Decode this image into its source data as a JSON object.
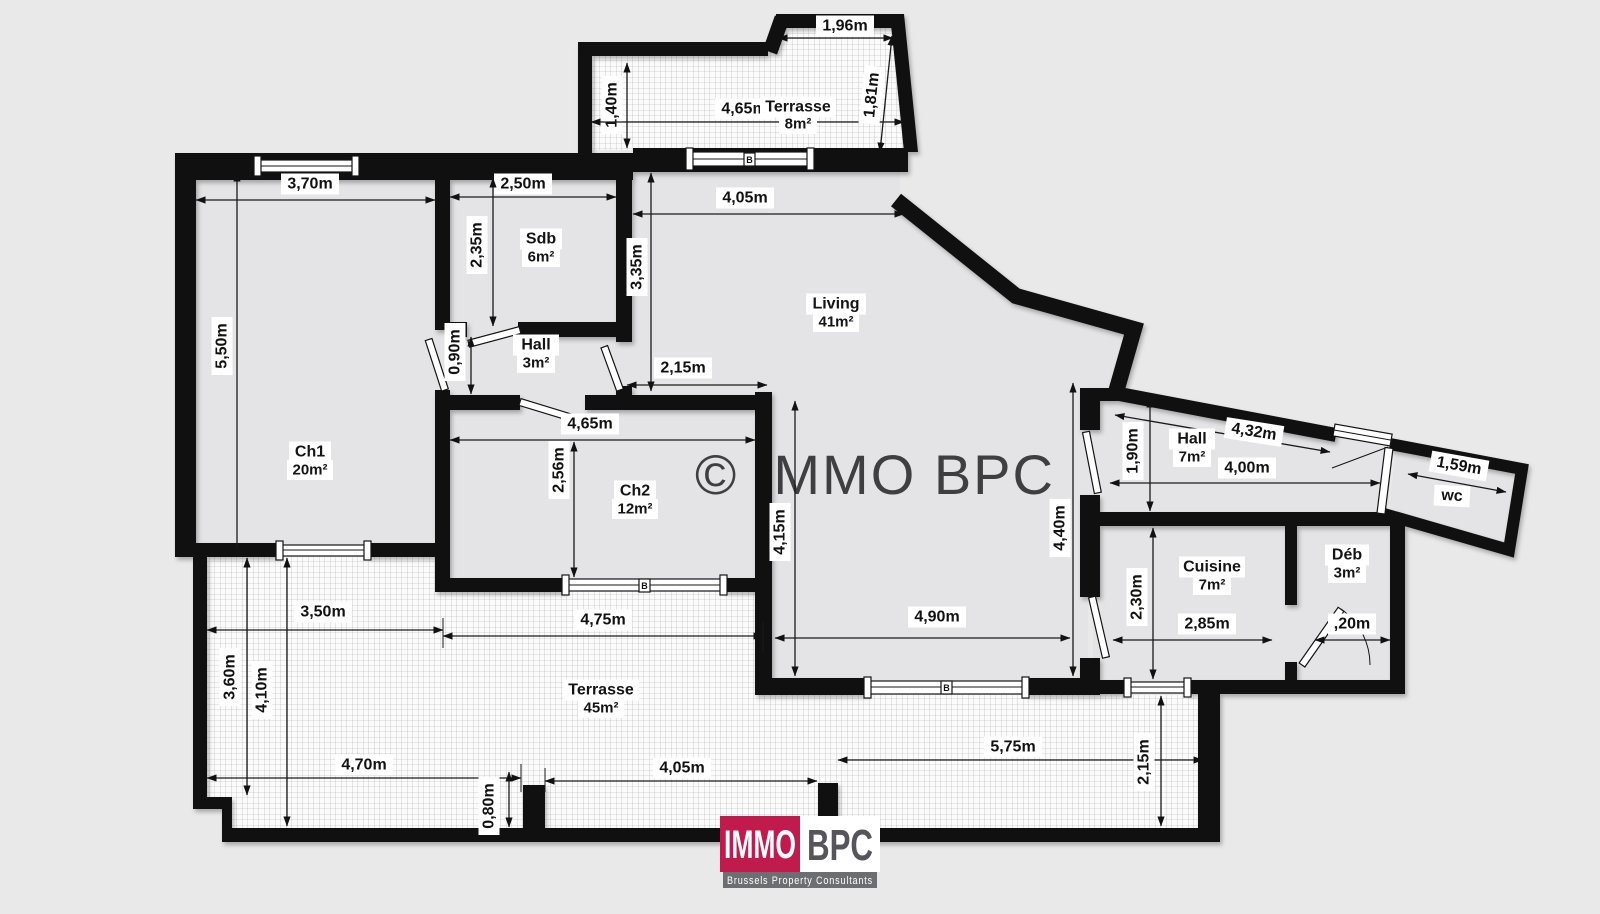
{
  "watermark": "© IMMO BPC",
  "rooms": {
    "terrasse_top": {
      "name": "Terrasse",
      "area": "8m²"
    },
    "sdb": {
      "name": "Sdb",
      "area": "6m²"
    },
    "hall_entry": {
      "name": "Hall",
      "area": "3m²"
    },
    "living": {
      "name": "Living",
      "area": "41m²"
    },
    "ch1": {
      "name": "Ch1",
      "area": "20m²"
    },
    "ch2": {
      "name": "Ch2",
      "area": "12m²"
    },
    "hall_night": {
      "name": "Hall",
      "area": "7m²"
    },
    "wc": {
      "name": "wc"
    },
    "cuisine": {
      "name": "Cuisine",
      "area": "7m²"
    },
    "deb": {
      "name": "Déb",
      "area": "3m²"
    },
    "terrasse_bottom": {
      "name": "Terrasse",
      "area": "45m²"
    }
  },
  "dims": {
    "terr_top_w1": "1,96m",
    "terr_top_h1": "1,40m",
    "terr_top_w2": "4,65m",
    "terr_top_h2": "1,81m",
    "ch1_top": "3,70m",
    "sdb_top": "2,50m",
    "ch1_left": "5,50m",
    "sdb_left": "2,35m",
    "living_left": "3,35m",
    "living_top": "4,05m",
    "hall_entry_h": "0,90m",
    "living_niche": "2,15m",
    "ch2_top": "4,65m",
    "ch2_left": "2,56m",
    "living_h1": "4,15m",
    "living_h2": "4,40m",
    "living_bottom": "4,90m",
    "hall_night_left": "1,90m",
    "hall_night_diag": "4,32m",
    "hall_night_w": "4,00m",
    "wc_w": "1,59m",
    "cuisine_left": "2,30m",
    "cuisine_w": "2,85m",
    "deb_w": ",20m",
    "terr_b_w1": "3,50m",
    "terr_b_w2": "4,75m",
    "terr_b_h1": "3,60m",
    "terr_b_h2": "4,10m",
    "terr_b_w3": "4,70m",
    "terr_b_step": "0,80m",
    "terr_b_w4": "4,05m",
    "terr_b_w5": "5,75m",
    "terr_b_h3": "2,15m"
  },
  "windows": {
    "marker": "B"
  },
  "logo": {
    "immo": "IMMO",
    "bpc": "BPC",
    "tagline": "Brussels Property Consultants"
  },
  "colors": {
    "logo_red": "#c11a4c",
    "logo_gray": "#6d6e71",
    "logo_text": "#55555b",
    "watermark_gray": "#3f3f42",
    "wall": "#101010"
  }
}
